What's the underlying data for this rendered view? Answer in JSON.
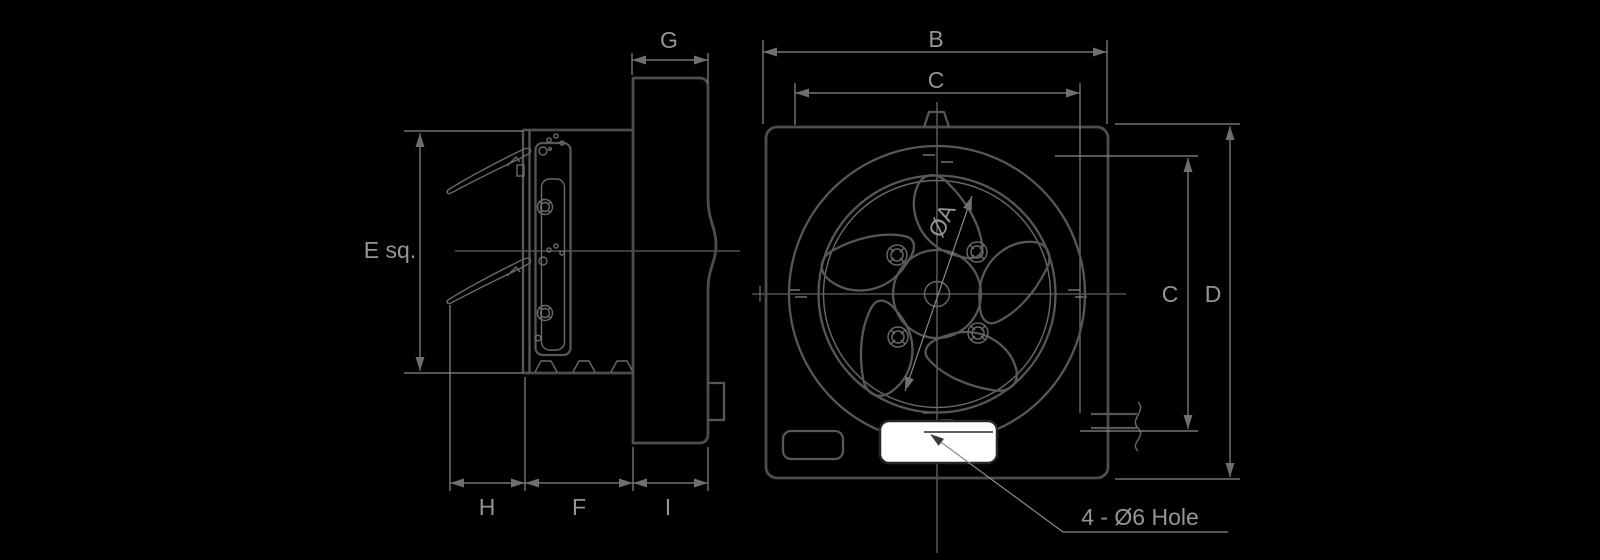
{
  "diagram": {
    "side_view": {
      "dim_e": "E sq.",
      "dim_g": "G",
      "dim_h": "H",
      "dim_f": "F",
      "dim_i": "I"
    },
    "front_view": {
      "dim_b": "B",
      "dim_c_width": "C",
      "dim_c_height": "C",
      "dim_d": "D",
      "dim_a": "ØA",
      "hole_note": "4 - Ø6 Hole"
    },
    "colors": {
      "background": "#000000",
      "outline": "#4d4d4d",
      "medium_line": "#575757",
      "dimension_line": "#8a8a8a",
      "text": "#959595",
      "nameplate_fill": "#ffffff",
      "nameplate_stroke": "#262626"
    }
  }
}
